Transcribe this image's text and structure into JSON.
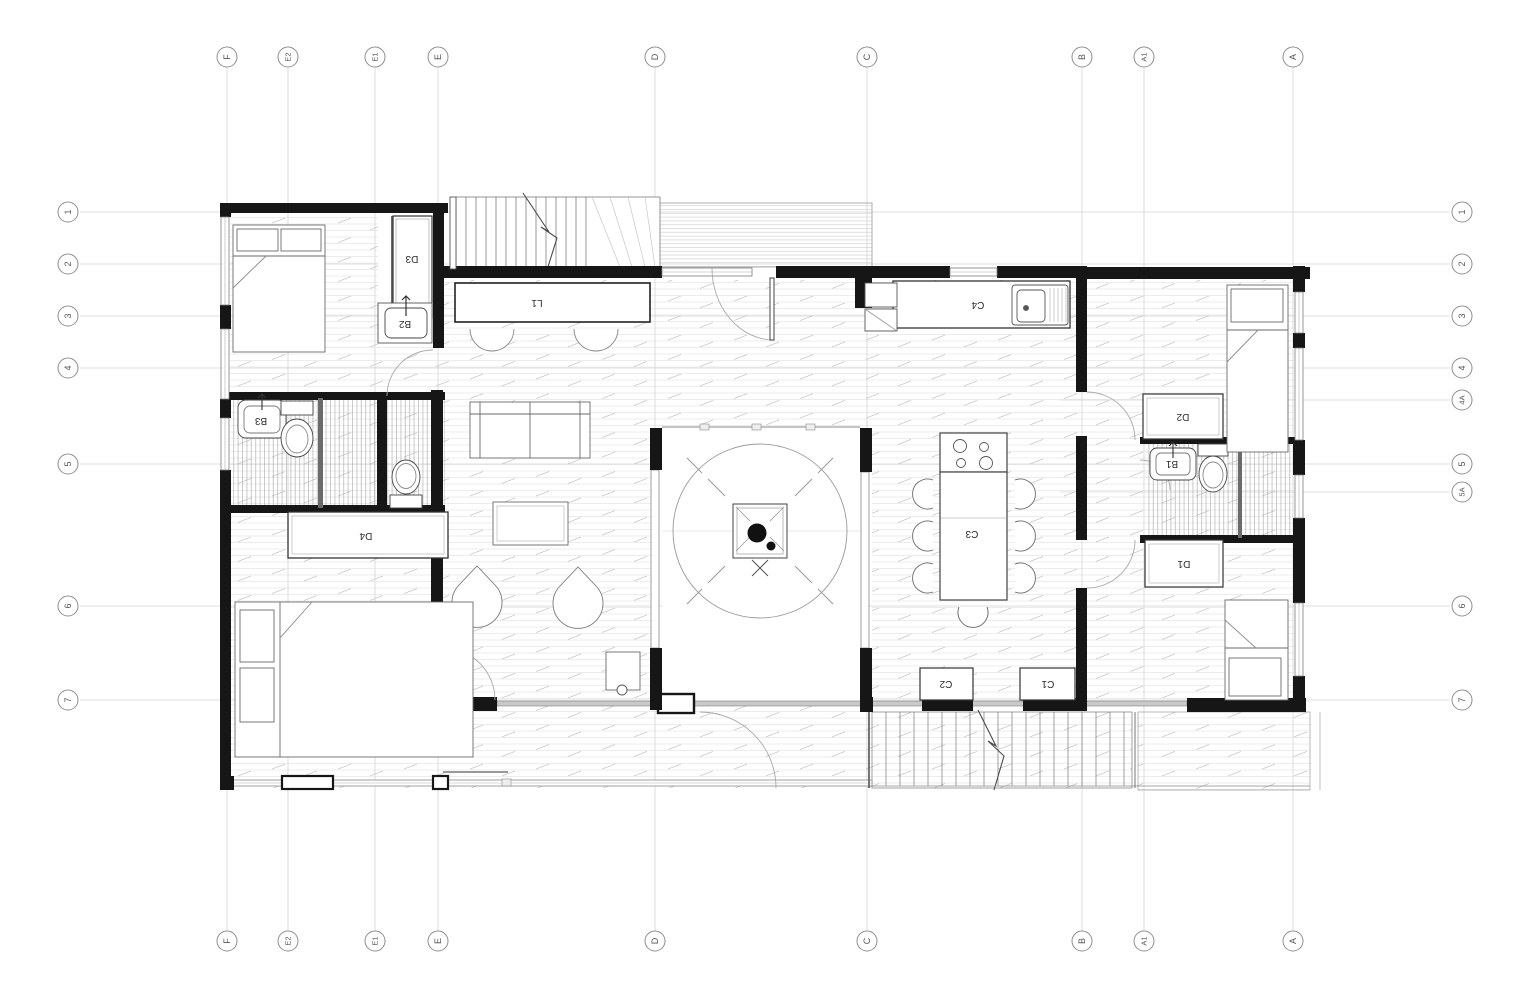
{
  "drawing": {
    "type": "architectural-floor-plan",
    "grid": {
      "columns": [
        {
          "label": "F",
          "x": 227
        },
        {
          "label": "E2",
          "x": 288
        },
        {
          "label": "E1",
          "x": 375
        },
        {
          "label": "E",
          "x": 438
        },
        {
          "label": "D",
          "x": 655
        },
        {
          "label": "C",
          "x": 867
        },
        {
          "label": "B",
          "x": 1082
        },
        {
          "label": "A1",
          "x": 1144
        },
        {
          "label": "A",
          "x": 1293
        }
      ],
      "rows": [
        {
          "label": "1",
          "y": 212,
          "sides": "both"
        },
        {
          "label": "2",
          "y": 264,
          "sides": "both"
        },
        {
          "label": "3",
          "y": 316,
          "sides": "both"
        },
        {
          "label": "4",
          "y": 368,
          "sides": "both"
        },
        {
          "label": "4A",
          "y": 400,
          "sides": "right"
        },
        {
          "label": "5",
          "y": 464,
          "sides": "both"
        },
        {
          "label": "5A",
          "y": 492,
          "sides": "right"
        },
        {
          "label": "6",
          "y": 606,
          "sides": "both"
        },
        {
          "label": "7",
          "y": 700,
          "sides": "both"
        }
      ]
    },
    "fixture_labels": {
      "d3": "D3",
      "b2": "B2",
      "l1": "L1",
      "b3": "B3",
      "d4": "D4",
      "c4": "C4",
      "c3": "C3",
      "c2": "C2",
      "c1": "C1",
      "d2": "D2",
      "b1": "B1",
      "d1": "D1"
    },
    "colors": {
      "wall": "#161616",
      "grid_line": "#d4d4d4",
      "bubble_stroke": "#8f8f8f",
      "bubble_text": "#555555",
      "furniture": "#5a5a5a",
      "light_line": "#999999"
    }
  }
}
